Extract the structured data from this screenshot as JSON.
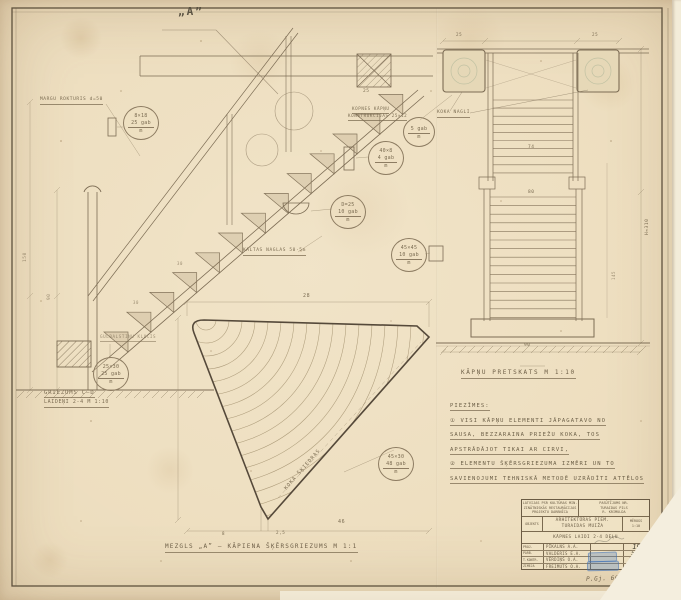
{
  "section": {
    "marker": "„A”",
    "handrail_label": "MARGU ROKTURIS d=50",
    "stringer_label_1": "KOPNES KĀPŅU",
    "stringer_label_2": "KONSTRUKCIJAS 25×12",
    "nails_label": "KALTAS NAGLAS 50·5m",
    "sleeper_label": "GULBALSTIŅU KLUCIS",
    "caption_line1": "GRIEZUMS C–D",
    "caption_line2": "LAIDEŅI 2-4  M 1:10",
    "dim_90": "90",
    "dim_150": "150",
    "dim_riser": "30",
    "dim_25": "25"
  },
  "parts": [
    {
      "dim": "8×18",
      "qty": "25 gab",
      "unit": "m"
    },
    {
      "dim": "",
      "qty": "5 gab",
      "unit": "m"
    },
    {
      "dim": "40×8",
      "qty": "4 gab",
      "unit": "m"
    },
    {
      "dim": "D=25",
      "qty": "10 gab",
      "unit": "m"
    },
    {
      "dim": "45×45",
      "qty": "10 gab",
      "unit": "m"
    },
    {
      "dim": "25×30",
      "qty": "25 gab",
      "unit": "m"
    },
    {
      "dim": "45×30",
      "qty": "48 gab",
      "unit": "m"
    }
  ],
  "detail": {
    "caption": "MEZGLS „A” — KĀPIENA ŠĶĒRSGRIEZUMS M 1:1",
    "grain_label": "KOKA ŠĶIEDRAS",
    "dim_top": "28",
    "dim_bottom": "46",
    "dim_apex": "2,5",
    "dim_left": "8"
  },
  "elevation": {
    "caption": "KĀPŅU PRETSKATS M 1:10",
    "nails_label": "KOKA NAGLI",
    "dim_upper": "74",
    "dim_lower": "80",
    "dim_height": "H≈310",
    "dim_width": "90",
    "dim_145": "145",
    "dim_post_left": "25",
    "dim_post_right": "25"
  },
  "notes": {
    "title": "PIEZĪMES:",
    "line1": "① VISI KĀPŅU ELEMENTI JĀPAGATAVO NO",
    "line2": "SAUSA, BEZZARAINA PRIEŽU KOKA, TOS",
    "line3": "APSTRĀDĀJOT TIKAI AR CIRVI,",
    "line4": "② ELEMENTU ŠĶĒRSGRIEZUMA IZMĒRI UN TO",
    "line5": "SAVIENOJUMI TEHNISKĀ METODĒ UZRĀDĪTI ATTĒLOS"
  },
  "titleblock": {
    "org_line1": "LATVIJAS PSR KULTŪRAS MIN.",
    "org_line2": "ZINĀTNISKĀS RESTAURĀCIJAS",
    "org_line3": "PROJEKTU DARBNĪCA",
    "right_line1": "PASŪTĪJUMS NR.",
    "right_line2": "TURAIDAS PILS",
    "right_line3": "R. KRIMULDA",
    "col_label": "OBJEKTS",
    "object_line1": "ARHITEKTŪRAS PIEM.",
    "object_line2": "TURAIDAS MUIŽA",
    "scale_label": "MĒROGS",
    "scale_value": "1:10",
    "sheet_title": "KĀPNES LAIDI 2-4  DEĻU",
    "rows": [
      {
        "role": "PROJ.",
        "name": "PĪKALNS A.A.",
        "extra": "19"
      },
      {
        "role": "PĀRB.",
        "name": "VALDERIS E.A.",
        "extra": "528"
      },
      {
        "role": "T.KONTR.",
        "name": "VĒRDIŅŠ O.A.",
        "extra": "7.I.62"
      },
      {
        "role": "ZĪMĒJA",
        "name": "FREIMUTS O.A.",
        "extra": "1962.g."
      }
    ],
    "pencil_note": "P.Gj. 662001"
  }
}
